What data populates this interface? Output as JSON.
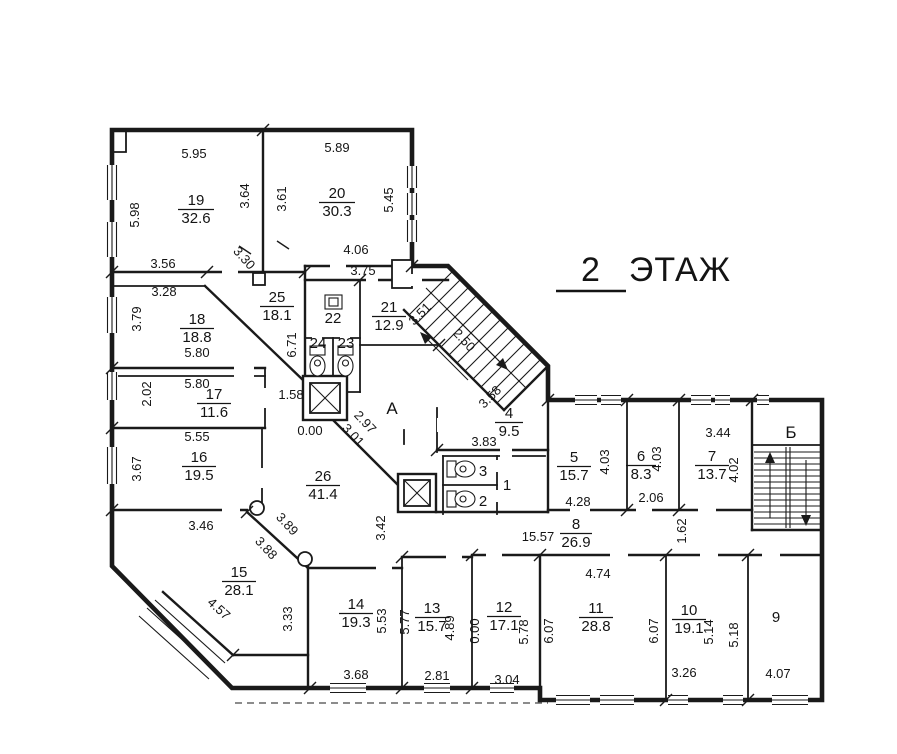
{
  "title": {
    "number": "2",
    "word": "ЭТАЖ"
  },
  "zones": {
    "lobby": "А",
    "stairwell": "Б"
  },
  "rooms": {
    "r19": {
      "num": "19",
      "area": "32.6"
    },
    "r20": {
      "num": "20",
      "area": "30.3"
    },
    "r25": {
      "num": "25",
      "area": "18.1"
    },
    "r18": {
      "num": "18",
      "area": "18.8"
    },
    "r17": {
      "num": "17",
      "area": "11.6"
    },
    "r16": {
      "num": "16",
      "area": "19.5"
    },
    "r15": {
      "num": "15",
      "area": "28.1"
    },
    "r26": {
      "num": "26",
      "area": "41.4"
    },
    "r21": {
      "num": "21",
      "area": "12.9"
    },
    "r22": {
      "num": "22"
    },
    "r24": {
      "num": "24"
    },
    "r23": {
      "num": "23"
    },
    "r4": {
      "num": "4",
      "area": "9.5"
    },
    "r5": {
      "num": "5",
      "area": "15.7"
    },
    "r6": {
      "num": "6",
      "area": "8.3"
    },
    "r7": {
      "num": "7",
      "area": "13.7"
    },
    "r8": {
      "num": "8",
      "area": "26.9"
    },
    "r3": {
      "num": "3"
    },
    "r2": {
      "num": "2"
    },
    "r1": {
      "num": "1"
    },
    "r14": {
      "num": "14",
      "area": "19.3"
    },
    "r13": {
      "num": "13",
      "area": "15.7"
    },
    "r12": {
      "num": "12",
      "area": "17.1"
    },
    "r11": {
      "num": "11",
      "area": "28.8"
    },
    "r10": {
      "num": "10",
      "area": "19.1"
    },
    "r9": {
      "num": "9"
    }
  },
  "dims": {
    "r19_top": "5.95",
    "r20_top": "5.89",
    "r19_left": "5.98",
    "r19_right": "3.64",
    "r20_left": "3.61",
    "r20_right": "5.45",
    "r19_bottom": "3.56",
    "r18_top": "3.28",
    "r25_diag": "3.30",
    "r20_bottom": "4.06",
    "r21_top": "3.75",
    "r18_left": "3.79",
    "r25_right": "6.71",
    "r21_diag": "3.51",
    "stair_width": "2.50",
    "r18_bottom": "5.80",
    "r17_top": "5.80",
    "r17_left": "2.02",
    "niche": "1.58",
    "r17_bottom": "5.55",
    "r16_left": "3.67",
    "level_lobby": "0.00",
    "lobby_diag1": "2.97",
    "lobby_diag2": "3.01",
    "stair_diag": "3.58",
    "r4_bottom": "3.83",
    "r26_left": "3.42",
    "r15_top": "3.46",
    "r15_diag1": "3.89",
    "r15_diag2": "3.88",
    "r15_sw": "4.57",
    "r5_right": "4.03",
    "r5_bottom": "4.28",
    "r6_right": "4.03",
    "r6_bottom": "2.06",
    "r7_top": "3.44",
    "r7_right": "4.02",
    "r8_len": "15.57",
    "r8_right": "1.62",
    "r11_top": "4.74",
    "r11_left": "6.07",
    "r10_left": "6.07",
    "r14_left": "3.33",
    "r14_right": "5.53",
    "r14_bottom": "3.68",
    "r13_left": "5.77",
    "r13_right": "4.89",
    "level_12": "0.00",
    "r13_bottom": "2.81",
    "r12_right": "5.78",
    "r12_bottom": "3.04",
    "r10_right": "5.14",
    "r10_bottom": "3.26",
    "r9_left": "5.18",
    "r9_bottom": "4.07"
  }
}
